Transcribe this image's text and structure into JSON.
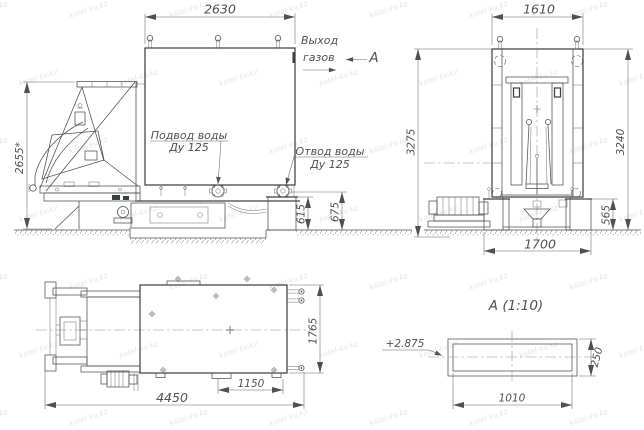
{
  "watermark": "kotel-kv.kz",
  "side_view": {
    "dim_top": "2630",
    "dim_left": "2655*",
    "dim_615": "615",
    "dim_675": "675",
    "inlet_line1": "Подвод воды",
    "inlet_line2": "Ду 125",
    "outlet_line1": "Отвод воды",
    "outlet_line2": "Ду 125",
    "gas_line1": "Выход",
    "gas_line2": "газов",
    "section_label": "А"
  },
  "front_view": {
    "dim_top": "1610",
    "dim_left": "3275",
    "dim_right": "3240",
    "dim_pedestal": "565",
    "dim_bottom": "1700"
  },
  "plan_view": {
    "dim_length": "4450",
    "dim_feet": "1150",
    "dim_width": "1765"
  },
  "detail_view": {
    "title": "А  (1:10)",
    "elevation": "+2.875",
    "dim_width": "1010",
    "dim_height": "250"
  }
}
